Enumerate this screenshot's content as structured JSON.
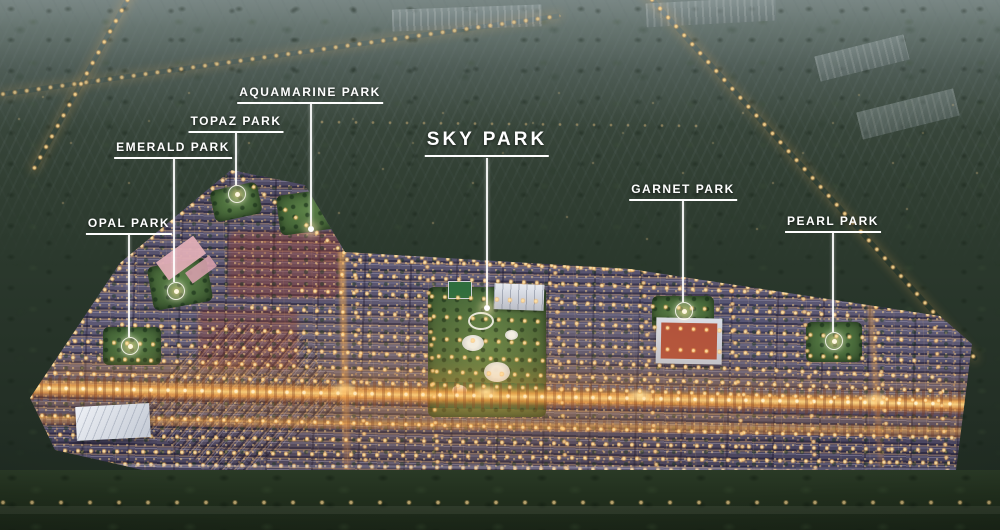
{
  "labels": {
    "opal": "OPAL PARK",
    "emerald": "EMERALD PARK",
    "topaz": "TOPAZ PARK",
    "aquamarine": "AQUAMARINE PARK",
    "sky": "SKY PARK",
    "garnet": "GARNET PARK",
    "pearl": "PEARL PARK"
  },
  "colors": {
    "label_text": "#ffffff",
    "street_light": "#ffd27c",
    "avenue_glow": "#f0a64e",
    "roof_violet": "#5b5773",
    "park_green": "#48693a",
    "forest_dark": "#2b392d",
    "haze_top": "#64716f"
  }
}
